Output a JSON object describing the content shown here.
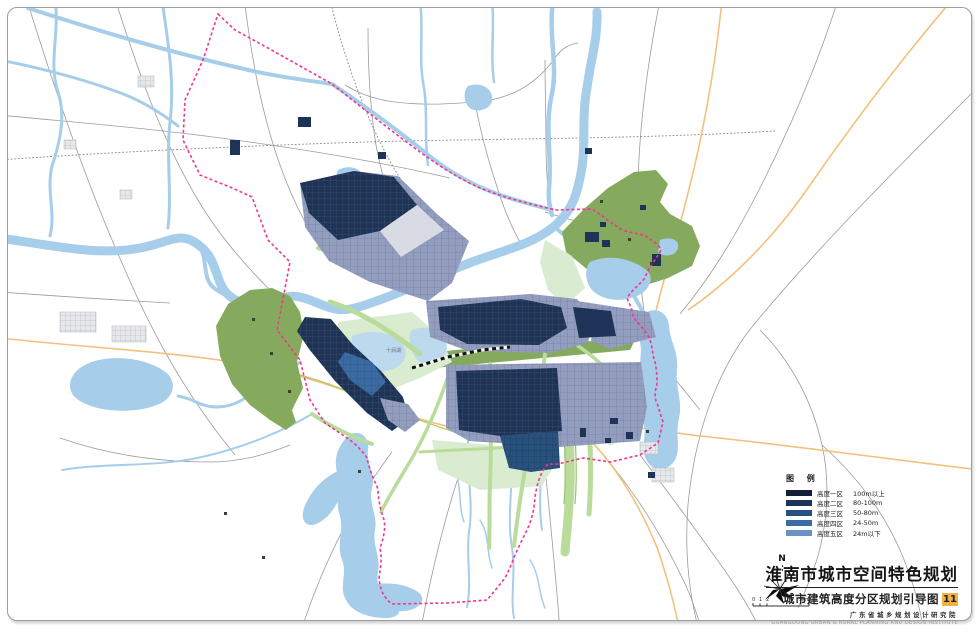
{
  "map": {
    "region_label": "十涧湖",
    "north_label": "N",
    "scale": {
      "tick_labels": [
        "0",
        "1",
        "2"
      ],
      "end_label": "5km"
    }
  },
  "legend": {
    "title": "图  例",
    "items": [
      {
        "name": "高度一区",
        "range": "100m以上",
        "color": "#141f36"
      },
      {
        "name": "高度二区",
        "range": "80-100m",
        "color": "#1d3357"
      },
      {
        "name": "高度三区",
        "range": "50-80m",
        "color": "#27517f"
      },
      {
        "name": "高度四区",
        "range": "24-50m",
        "color": "#3a6ba3"
      },
      {
        "name": "高度五区",
        "range": "24m以下",
        "color": "#6c92c4"
      }
    ]
  },
  "title_block": {
    "title": "淮南市城市空间特色规划",
    "subtitle": "城市建筑高度分区规划引导图",
    "figure_number": "11",
    "institute_cn": "广东省城乡规划设计研究院",
    "institute_en": "GUANGDONG URBAN & RURAL PLANNING AND DESIGN INSTITUTE"
  },
  "palette": {
    "river": "#a6cde9",
    "river-light": "#bcd9ee",
    "hill": "#85aa5e",
    "mint": "#d9ecd0",
    "corridor": "#b9dc9a",
    "corridor-dark": "#93c272",
    "urban-lav": "#939dc0",
    "urban-gray": "#d8dbe3",
    "road": "#9b9ba0",
    "rail": "#86868c",
    "orange": "#f3c17e",
    "olive-line": "#b4c96a",
    "boundary": "#f0368e",
    "badge": "#f0b243",
    "z1": "#141f36",
    "z2": "#1d3357",
    "z3": "#27517f",
    "z4": "#3a6ba3",
    "z5": "#6c92c4"
  }
}
